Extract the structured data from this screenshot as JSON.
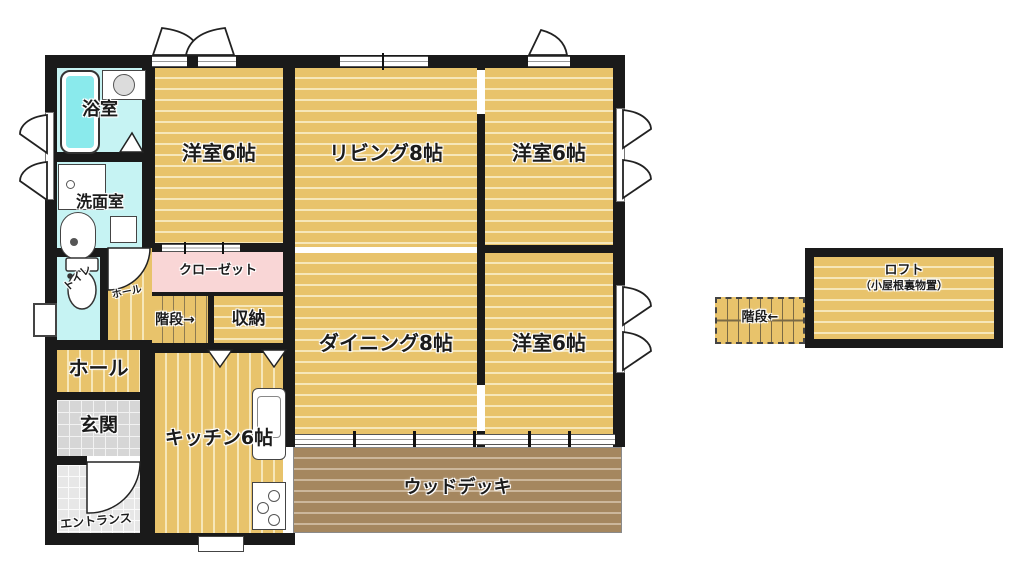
{
  "labels": {
    "bathroom": "浴室",
    "washroom": "洗面室",
    "toilet": "トイレ",
    "hall_small": "ホール",
    "closet": "クローゼット",
    "stairs_up": "階段→",
    "storage": "収納",
    "hall": "ホール",
    "genkan": "玄関",
    "entrance": "エントランス",
    "kitchen": "キッチン6帖",
    "western_room_top_left": "洋室6帖",
    "living": "リビング8帖",
    "western_room_top_right": "洋室6帖",
    "dining": "ダイニング8帖",
    "western_room_bottom_right": "洋室6帖",
    "wood_deck": "ウッドデッキ",
    "loft": "ロフト",
    "loft_sub": "（小屋根裏物置）",
    "stairs_down": "階段←"
  },
  "colors": {
    "wall": "#1a1a1a",
    "wood_floor": "#e8c36b",
    "wood_stripe": "#f6e7ba",
    "wet_room_floor": "#c6f3f3",
    "bathtub_fill": "#8aeaec",
    "closet_pink": "#f9d6d6",
    "genkan_tile": "#d6d6d6",
    "entrance_tile": "#e7e7e7",
    "deck_brown": "#a5875f",
    "deck_stripe": "#ccb79b"
  }
}
